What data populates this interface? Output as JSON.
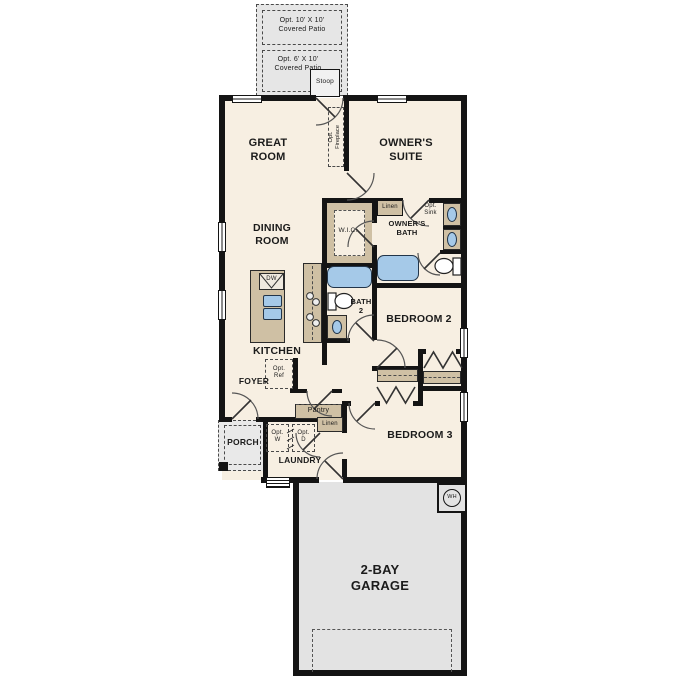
{
  "colors": {
    "wall": "#141414",
    "floor": "#f7efe2",
    "patio_gray": "#e6e6e6",
    "garage_gray": "#e3e3e3",
    "counter_tan": "#cfc0a4",
    "fixture_blue": "#a5c9e8",
    "door_line": "#555555"
  },
  "patio": {
    "top": {
      "l1": "Opt. 10' X 10'",
      "l2": "Covered Patio"
    },
    "bottom": {
      "l1": "Opt. 6' X 10'",
      "l2": "Covered Patio"
    },
    "stoop": "Stoop"
  },
  "rooms": {
    "great_room": {
      "l1": "GREAT",
      "l2": "ROOM"
    },
    "owners_suite": {
      "l1": "OWNER'S",
      "l2": "SUITE"
    },
    "dining": {
      "l1": "DINING",
      "l2": "ROOM"
    },
    "kitchen": "KITCHEN",
    "wic": "W.I.C.",
    "owners_bath": {
      "l1": "OWNER'S",
      "l2": "BATH"
    },
    "bath2": {
      "l1": "BATH",
      "l2": "2"
    },
    "bedroom2": "BEDROOM 2",
    "bedroom3": "BEDROOM 3",
    "foyer": "FOYER",
    "porch": "PORCH",
    "laundry": "LAUNDRY",
    "garage": {
      "l1": "2-BAY",
      "l2": "GARAGE"
    }
  },
  "features": {
    "opt_fireplace": {
      "l1": "Opt.",
      "l2": "Fireplace"
    },
    "linen_bath": "Linen",
    "linen_laundry": "Linen",
    "opt_sink": {
      "l1": "Opt.",
      "l2": "Sink"
    },
    "opt_ref": {
      "l1": "Opt.",
      "l2": "Ref"
    },
    "opt_washer": {
      "l1": "Opt.",
      "l2": "W"
    },
    "opt_dryer": {
      "l1": "Opt.",
      "l2": "D"
    },
    "pantry": "Pantry",
    "dishwasher": "DW",
    "water_heater": "WH"
  }
}
